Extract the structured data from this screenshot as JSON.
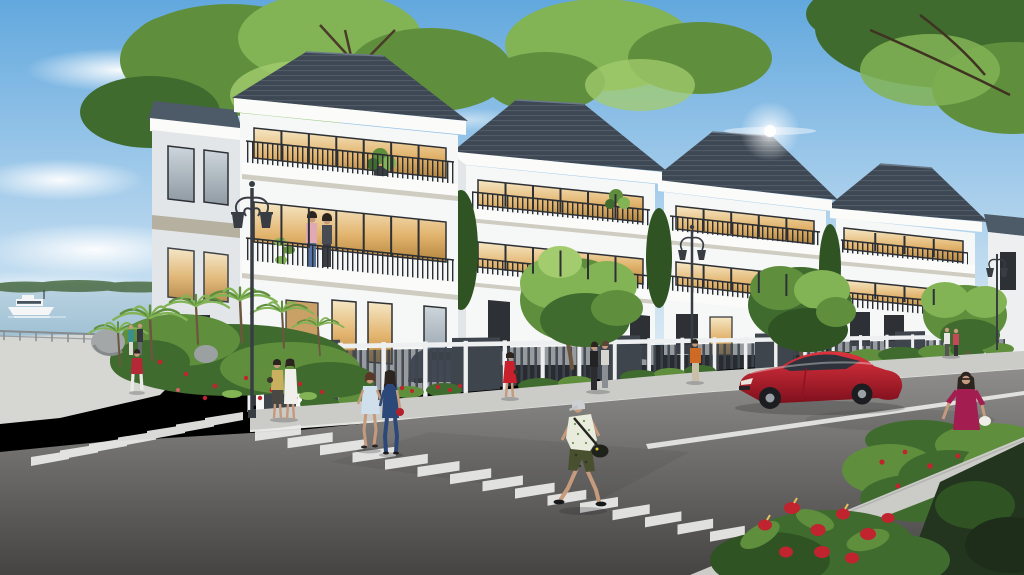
{
  "scene": {
    "title": "riverside-villa-neighborhood-rendering",
    "setting": "sunny daytime architectural rendering of a row of three-storey white villas with dark hip roofs along a street corner beside a river",
    "objects": [
      {
        "name": "sky",
        "detail": "blue sky with wispy white clouds"
      },
      {
        "name": "river",
        "detail": "water at far left with distant green tree line"
      },
      {
        "name": "tour-boat",
        "detail": "small white boat with dark window strip on the river"
      },
      {
        "name": "promenade-railing",
        "detail": "low railing along the waterfront walk"
      },
      {
        "name": "villa-row",
        "count": 5,
        "detail": "white villas, greige accent bands, dark balcony railings, warm lit glass doors, dark slate hip roofs"
      },
      {
        "name": "balcony-couple",
        "detail": "man in pink shirt and woman in dark top on villa-1 middle balcony"
      },
      {
        "name": "street-lamps",
        "count": 3,
        "detail": "black double-arm classic lanterns"
      },
      {
        "name": "boundary-fence",
        "detail": "white posts with dark vertical-slat panels and darker gates"
      },
      {
        "name": "driveway-car",
        "detail": "dark grey sedan behind villa-1 fence"
      },
      {
        "name": "red-sedan",
        "detail": "red sedan parked along the right kerb"
      },
      {
        "name": "main-crosswalk",
        "detail": "white zebra stripes running diagonally across the foreground street"
      },
      {
        "name": "side-crosswalk",
        "detail": "zebra stripes on the left side street"
      },
      {
        "name": "lane-line",
        "detail": "white diagonal lane marking at right"
      },
      {
        "name": "corner-garden",
        "detail": "tropical palms, red flowers and boulders at the street corner"
      },
      {
        "name": "anthurium-bed",
        "detail": "red anthurium flowers in the bottom-right foreground"
      },
      {
        "name": "rose-bushes",
        "detail": "red-flowered shrubs at right"
      },
      {
        "name": "sun-flare",
        "detail": "bright glare above villa-3 roof"
      }
    ],
    "people": [
      {
        "name": "crossing-man",
        "clothing": "grey cap, white-green floral shirt, camo shorts, black duffel bag"
      },
      {
        "name": "blue-dress-woman",
        "clothing": "light blue dress, auburn hair"
      },
      {
        "name": "navy-jumpsuit-woman",
        "clothing": "navy jumpsuit, red handbag"
      },
      {
        "name": "magenta-dress-woman",
        "clothing": "magenta dress, white handbag, sunglasses"
      },
      {
        "name": "red-top-woman",
        "clothing": "red top, white trousers"
      },
      {
        "name": "promenade-couple",
        "clothing": "teal top and dark top"
      },
      {
        "name": "gate-women",
        "clothing": "olive top with dark skirt; white dress"
      },
      {
        "name": "red-dress-woman",
        "clothing": "short red dress"
      },
      {
        "name": "villa2-sidewalk-pair",
        "clothing": "black outfit; light grey outfit"
      },
      {
        "name": "orange-jacket-walker",
        "clothing": "orange jacket, tan trousers"
      },
      {
        "name": "distant-pair",
        "clothing": "white top; coral top"
      }
    ]
  },
  "colors": {
    "sky_top": "#62a8de",
    "sky_mid": "#a6cdeb",
    "sky_low": "#d9e9f4",
    "cloud": "#ffffff",
    "tree_deep": "#2f5323",
    "tree_dark": "#406b2e",
    "tree_mid": "#5f8f3d",
    "tree_light": "#82b355",
    "tree_bright": "#a3cc6e",
    "water_far": "#bcd4e2",
    "water_near": "#9fc1d4",
    "shore": "#4e6f49",
    "roof_dark": "#3d4854",
    "roof_mid": "#4d5a68",
    "roof_light": "#6a7888",
    "wall_white": "#f6f7f7",
    "wall_shade": "#e3e6e9",
    "wall_far": "#edeff1",
    "fascia": "#fbfbfa",
    "band_greige": "#b5b09f",
    "slab_shadow": "#cfccc1",
    "window_frame": "#2d3035",
    "curtain": "#f2e2bd",
    "railing": "#2b2e33",
    "fence_panel": "#3f454c",
    "fence_post": "#edeff0",
    "lamp": "#383d43",
    "sidewalk": "#cbccc8",
    "walkway": "#d6d7d3",
    "curb": "#e3e4e0",
    "stripe_white": "#ebecea",
    "road_far": "#8e8d8b",
    "road_near": "#454443",
    "car_red_hi": "#de3440",
    "car_red_lo": "#7e0f1c",
    "car_glass": "#2e333b",
    "wheel": "#1b1d20",
    "hub": "#9aa0a6",
    "boat_white": "#f3f5f6",
    "boat_dark": "#46525c",
    "flower_red": "#c0242e",
    "skin": "#c69a7d",
    "hair_dark": "#2c241e",
    "wood_door": "#c9a066",
    "trunk": "#6b573f"
  }
}
